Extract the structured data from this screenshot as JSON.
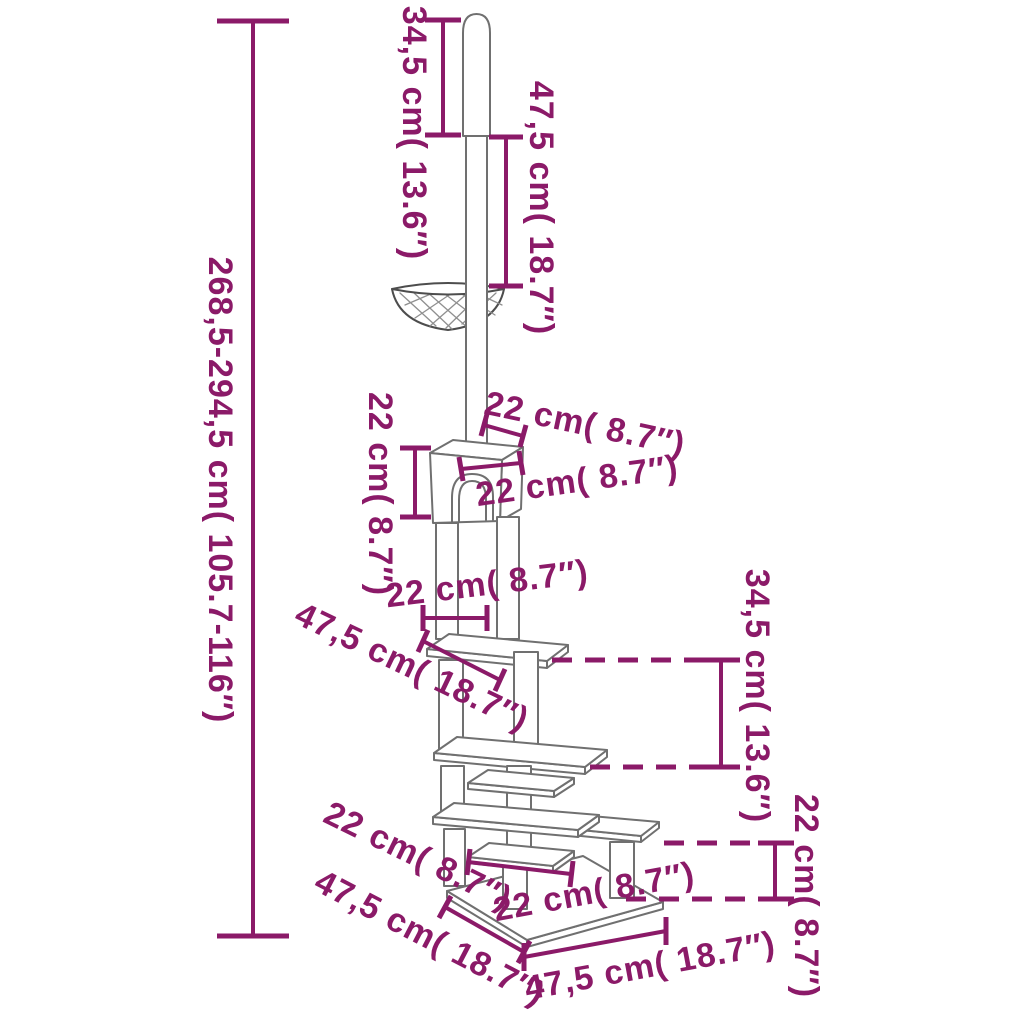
{
  "diagram_type": "product dimension diagram",
  "subject": "floor-to-ceiling cat tree with hammock, house, platforms and base",
  "units": "cm and inches",
  "colors": {
    "dimension_annotations": "#8B1A68",
    "line_art": "#707070",
    "background": "#FFFFFF"
  },
  "dimensions": {
    "pole_top_segment": "34,5 cm( 13.6″)",
    "pole_upper_section": "47,5 cm( 18.7″)",
    "overall_height": "268,5-294,5 cm( 105.7-116″)",
    "house_height": "22 cm( 8.7″)",
    "house_top_depth": "22 cm( 8.7″)",
    "house_front_width": "22 cm( 8.7″)",
    "post_spacing": "22 cm( 8.7″)",
    "top_platform_width": "47,5 cm( 18.7″)",
    "mid_section_height": "34,5 cm( 13.6″)",
    "lower_section_height": "22 cm( 8.7″)",
    "lower_left_step": "22 cm( 8.7″)",
    "base_depth_left": "47,5 cm( 18.7″)",
    "bottom_platform_width": "22 cm( 8.7″)",
    "base_width_front": "47,5 cm( 18.7″)"
  }
}
